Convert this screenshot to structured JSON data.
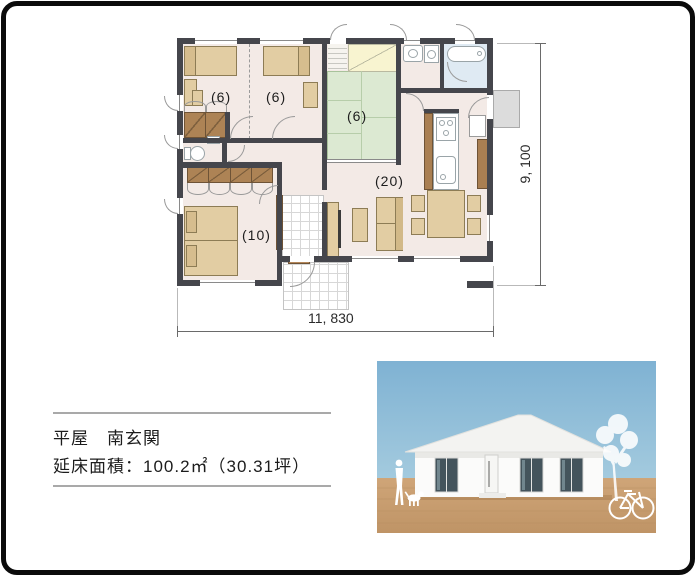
{
  "plan": {
    "labels": {
      "bedroom1": "(6)",
      "bedroom2": "(6)",
      "tatami": "(6)",
      "master_bedroom": "(10)",
      "ldk": "(20)"
    },
    "dims": {
      "width": "11, 830",
      "height": "9, 100"
    },
    "colors": {
      "wall": "#45464c",
      "floor": "#f3eae6",
      "tatami": "#dce9d2",
      "storage_yellow": "#f8f4d0",
      "wood": "#a97f52",
      "closet": "#ad8355",
      "furniture": "#e2cda3",
      "bath_floor": "#dfeaf3"
    }
  },
  "caption": {
    "line1": "平屋　南玄関",
    "line2": "延床面積：100.2㎡（30.31坪）"
  },
  "photo": {
    "colors": {
      "sky": "#86b7d6",
      "ground": "#c59c6e",
      "house": "#f7f7f5",
      "window": "#41525a"
    }
  }
}
